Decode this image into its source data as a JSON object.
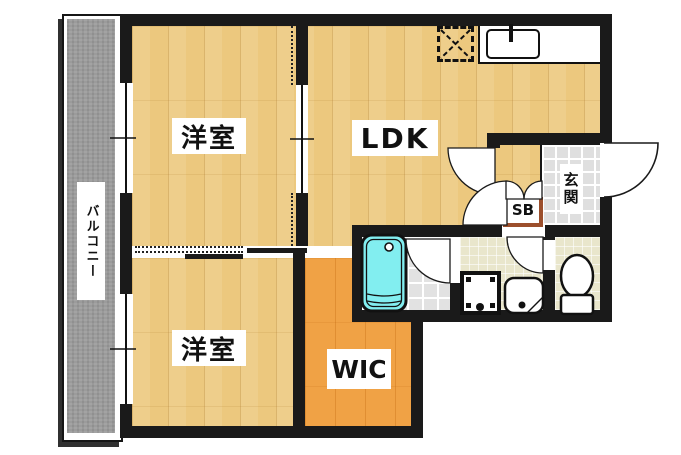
{
  "floorplan": {
    "rooms": {
      "bedroom_top": {
        "label": "洋室"
      },
      "bedroom_bottom": {
        "label": "洋室"
      },
      "ldk": {
        "label": "LDK"
      },
      "wic": {
        "label": "WIC"
      },
      "entrance": {
        "label": "玄関"
      },
      "shoe_box": {
        "label": "SB"
      },
      "balcony": {
        "label": "バルコニー"
      }
    },
    "fixtures": [
      "bathtub",
      "kitchen-sink",
      "refrigerator-space",
      "washing-machine-pan",
      "washbasin",
      "toilet",
      "entrance-door",
      "room-doors",
      "sliding-doors",
      "windows"
    ],
    "colors": {
      "wood_floor": "#ecc87e",
      "wic_floor": "#f0a245",
      "balcony_floor": "#9b9b9b",
      "entrance_tile": "#dfdfdf",
      "bath_tile": "#e2e2e2",
      "washroom_floor": "#e9e6cc",
      "bathtub_fill": "#82eef0",
      "wall": "#1a1a1a",
      "shoebox_border": "#9c4f2c"
    }
  }
}
